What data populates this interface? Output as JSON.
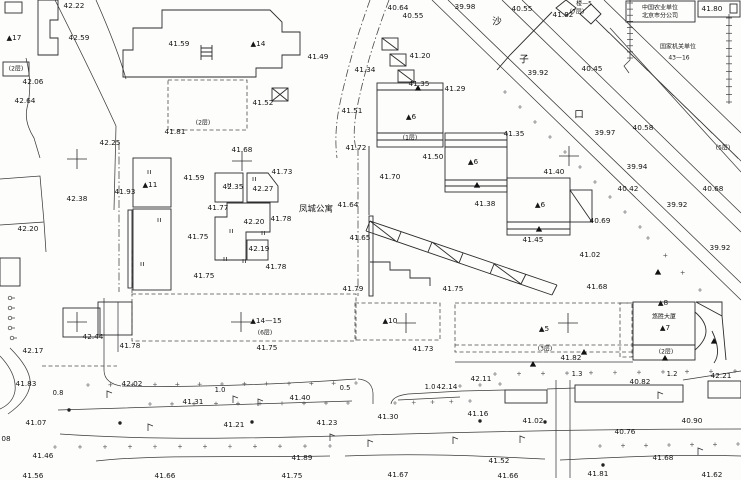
{
  "map": {
    "ink": "#161616",
    "line_color": "#3b3b3b",
    "background": "#fdfdfc",
    "labels": [
      {
        "t": "42.22",
        "x": 74,
        "y": 6
      },
      {
        "t": "40.64",
        "x": 398,
        "y": 8
      },
      {
        "t": "40.55",
        "x": 413,
        "y": 16
      },
      {
        "t": "39.98",
        "x": 465,
        "y": 7
      },
      {
        "t": "40.55",
        "x": 522,
        "y": 9
      },
      {
        "t": "41.82",
        "x": 563,
        "y": 15
      },
      {
        "t": "楼—5",
        "x": 584,
        "y": 4,
        "cls": "floors"
      },
      {
        "t": "(7层)",
        "x": 577,
        "y": 12,
        "cls": "floors"
      },
      {
        "t": "中国农业单位",
        "x": 660,
        "y": 8,
        "cls": "name-sm"
      },
      {
        "t": "北京市分公司",
        "x": 660,
        "y": 16,
        "cls": "name-sm"
      },
      {
        "t": "41.80",
        "x": 712,
        "y": 9
      },
      {
        "t": "▲17",
        "x": 14,
        "y": 38,
        "cls": "bldg"
      },
      {
        "t": "42.59",
        "x": 79,
        "y": 38
      },
      {
        "t": "41.59",
        "x": 179,
        "y": 44
      },
      {
        "t": "▲14",
        "x": 258,
        "y": 44,
        "cls": "bldg"
      },
      {
        "t": "沙",
        "x": 497,
        "y": 22,
        "cls": "street"
      },
      {
        "t": "子",
        "x": 524,
        "y": 60,
        "cls": "street"
      },
      {
        "t": "口",
        "x": 579,
        "y": 115,
        "cls": "street"
      },
      {
        "t": "国家机关单位",
        "x": 678,
        "y": 47,
        "cls": "name-sm"
      },
      {
        "t": "43—16",
        "x": 679,
        "y": 58,
        "cls": "name-sm"
      },
      {
        "t": "41.20",
        "x": 420,
        "y": 56
      },
      {
        "t": "41.34",
        "x": 365,
        "y": 70
      },
      {
        "t": "41.49",
        "x": 318,
        "y": 57
      },
      {
        "t": "42.06",
        "x": 33,
        "y": 82
      },
      {
        "t": "40.45",
        "x": 592,
        "y": 69
      },
      {
        "t": "39.92",
        "x": 538,
        "y": 73
      },
      {
        "t": "(2层)",
        "x": 16,
        "y": 69,
        "cls": "floors"
      },
      {
        "t": "42.64",
        "x": 25,
        "y": 101
      },
      {
        "t": "41.35",
        "x": 419,
        "y": 84
      },
      {
        "t": "41.29",
        "x": 455,
        "y": 89
      },
      {
        "t": "41.52",
        "x": 263,
        "y": 103
      },
      {
        "t": "41.51",
        "x": 352,
        "y": 111
      },
      {
        "t": "▲6",
        "x": 411,
        "y": 117,
        "cls": "bldg"
      },
      {
        "t": "(2层)",
        "x": 203,
        "y": 123,
        "cls": "floors"
      },
      {
        "t": "41.81",
        "x": 175,
        "y": 132
      },
      {
        "t": "40.58",
        "x": 643,
        "y": 128
      },
      {
        "t": "39.97",
        "x": 605,
        "y": 133
      },
      {
        "t": "41.35",
        "x": 514,
        "y": 134
      },
      {
        "t": "(5层)",
        "x": 723,
        "y": 148,
        "cls": "floors"
      },
      {
        "t": "42.25",
        "x": 110,
        "y": 143
      },
      {
        "t": "41.72",
        "x": 356,
        "y": 148
      },
      {
        "t": "41.68",
        "x": 242,
        "y": 150
      },
      {
        "t": "(1层)",
        "x": 410,
        "y": 138,
        "cls": "floors"
      },
      {
        "t": "41.50",
        "x": 433,
        "y": 157
      },
      {
        "t": "▲6",
        "x": 473,
        "y": 162,
        "cls": "bldg"
      },
      {
        "t": "41.40",
        "x": 554,
        "y": 172
      },
      {
        "t": "39.94",
        "x": 637,
        "y": 167
      },
      {
        "t": "41.73",
        "x": 282,
        "y": 172
      },
      {
        "t": "41.59",
        "x": 194,
        "y": 178
      },
      {
        "t": "41.70",
        "x": 390,
        "y": 177
      },
      {
        "t": "▲11",
        "x": 150,
        "y": 185,
        "cls": "bldg"
      },
      {
        "t": "41.93",
        "x": 125,
        "y": 192
      },
      {
        "t": "42.35",
        "x": 233,
        "y": 187
      },
      {
        "t": "42.27",
        "x": 263,
        "y": 189
      },
      {
        "t": "40.42",
        "x": 628,
        "y": 189
      },
      {
        "t": "40.68",
        "x": 713,
        "y": 189
      },
      {
        "t": "42.38",
        "x": 77,
        "y": 199
      },
      {
        "t": "41.77",
        "x": 218,
        "y": 208
      },
      {
        "t": "▲6",
        "x": 540,
        "y": 205,
        "cls": "bldg"
      },
      {
        "t": "41.38",
        "x": 485,
        "y": 204
      },
      {
        "t": "41.64",
        "x": 348,
        "y": 205
      },
      {
        "t": "凤城公寓",
        "x": 316,
        "y": 209,
        "cls": "name"
      },
      {
        "t": "39.92",
        "x": 677,
        "y": 205
      },
      {
        "t": "40.69",
        "x": 600,
        "y": 221
      },
      {
        "t": "42.20",
        "x": 254,
        "y": 222
      },
      {
        "t": "41.78",
        "x": 281,
        "y": 219
      },
      {
        "t": "42.20",
        "x": 28,
        "y": 229
      },
      {
        "t": "41.75",
        "x": 198,
        "y": 237
      },
      {
        "t": "41.65",
        "x": 360,
        "y": 238
      },
      {
        "t": "41.45",
        "x": 533,
        "y": 240
      },
      {
        "t": "39.92",
        "x": 720,
        "y": 248
      },
      {
        "t": "42.19",
        "x": 259,
        "y": 249
      },
      {
        "t": "41.02",
        "x": 590,
        "y": 255
      },
      {
        "t": "41.78",
        "x": 276,
        "y": 267
      },
      {
        "t": "41.75",
        "x": 204,
        "y": 276
      },
      {
        "t": "41.68",
        "x": 597,
        "y": 287
      },
      {
        "t": "41.79",
        "x": 353,
        "y": 289
      },
      {
        "t": "41.75",
        "x": 453,
        "y": 289
      },
      {
        "t": "▲8",
        "x": 663,
        "y": 303,
        "cls": "bldg"
      },
      {
        "t": "▲14—15",
        "x": 266,
        "y": 321,
        "cls": "bldg"
      },
      {
        "t": "▲10",
        "x": 390,
        "y": 321,
        "cls": "bldg"
      },
      {
        "t": "▲5",
        "x": 544,
        "y": 329,
        "cls": "bldg"
      },
      {
        "t": "悠胜大厦",
        "x": 664,
        "y": 317,
        "cls": "name-sm"
      },
      {
        "t": "▲7",
        "x": 665,
        "y": 328,
        "cls": "bldg"
      },
      {
        "t": "(6层)",
        "x": 265,
        "y": 333,
        "cls": "floors"
      },
      {
        "t": "42.44",
        "x": 93,
        "y": 337
      },
      {
        "t": "41.78",
        "x": 130,
        "y": 346
      },
      {
        "t": "41.75",
        "x": 267,
        "y": 348
      },
      {
        "t": "41.73",
        "x": 423,
        "y": 349
      },
      {
        "t": "(3层)",
        "x": 545,
        "y": 349,
        "cls": "floors"
      },
      {
        "t": "(2层)",
        "x": 666,
        "y": 352,
        "cls": "floors"
      },
      {
        "t": "42.17",
        "x": 33,
        "y": 351
      },
      {
        "t": "41.82",
        "x": 571,
        "y": 358
      },
      {
        "t": "41.83",
        "x": 26,
        "y": 384
      },
      {
        "t": "42.02",
        "x": 132,
        "y": 384
      },
      {
        "t": "0.8",
        "x": 58,
        "y": 393,
        "cls": "width"
      },
      {
        "t": "1.0",
        "x": 220,
        "y": 390,
        "cls": "width"
      },
      {
        "t": "41.31",
        "x": 193,
        "y": 402
      },
      {
        "t": "41.40",
        "x": 300,
        "y": 398
      },
      {
        "t": "0.5",
        "x": 345,
        "y": 388,
        "cls": "width"
      },
      {
        "t": "1.0",
        "x": 430,
        "y": 387,
        "cls": "width"
      },
      {
        "t": "42.14",
        "x": 447,
        "y": 387
      },
      {
        "t": "42.11",
        "x": 481,
        "y": 379
      },
      {
        "t": "1.3",
        "x": 577,
        "y": 374,
        "cls": "width"
      },
      {
        "t": "1.2",
        "x": 672,
        "y": 374,
        "cls": "width"
      },
      {
        "t": "42.21",
        "x": 721,
        "y": 376
      },
      {
        "t": "40.82",
        "x": 640,
        "y": 382
      },
      {
        "t": "41.07",
        "x": 36,
        "y": 423
      },
      {
        "t": "41.21",
        "x": 234,
        "y": 425
      },
      {
        "t": "41.23",
        "x": 327,
        "y": 423
      },
      {
        "t": "41.30",
        "x": 388,
        "y": 417
      },
      {
        "t": "41.16",
        "x": 478,
        "y": 414
      },
      {
        "t": "41.02",
        "x": 533,
        "y": 421
      },
      {
        "t": "40.90",
        "x": 692,
        "y": 421
      },
      {
        "t": "40.76",
        "x": 625,
        "y": 432
      },
      {
        "t": "08",
        "x": 6,
        "y": 439
      },
      {
        "t": "41.46",
        "x": 43,
        "y": 456
      },
      {
        "t": "41.89",
        "x": 302,
        "y": 458
      },
      {
        "t": "41.52",
        "x": 499,
        "y": 461
      },
      {
        "t": "41.68",
        "x": 663,
        "y": 458
      },
      {
        "t": "41.56",
        "x": 33,
        "y": 476
      },
      {
        "t": "41.66",
        "x": 165,
        "y": 476
      },
      {
        "t": "41.75",
        "x": 292,
        "y": 476
      },
      {
        "t": "41.67",
        "x": 398,
        "y": 475
      },
      {
        "t": "41.66",
        "x": 508,
        "y": 476
      },
      {
        "t": "41.81",
        "x": 598,
        "y": 474
      },
      {
        "t": "41.62",
        "x": 712,
        "y": 475
      }
    ],
    "crosses": [
      [
        77,
        159
      ],
      [
        242,
        161
      ],
      [
        569,
        156
      ],
      [
        77,
        322
      ],
      [
        241,
        322
      ],
      [
        406,
        323
      ],
      [
        568,
        323
      ]
    ],
    "triangles": [
      [
        418,
        88
      ],
      [
        477,
        185
      ],
      [
        539,
        229
      ],
      [
        584,
        352
      ],
      [
        533,
        364
      ],
      [
        665,
        358
      ],
      [
        714,
        341
      ],
      [
        658,
        272
      ]
    ],
    "door_ticks": [
      [
        228,
        183
      ],
      [
        253,
        177
      ],
      [
        230,
        229
      ],
      [
        224,
        257
      ],
      [
        243,
        259
      ],
      [
        262,
        231
      ],
      [
        148,
        170
      ],
      [
        158,
        218
      ],
      [
        141,
        262
      ]
    ],
    "lamps": [
      [
        107,
        398
      ],
      [
        233,
        403
      ],
      [
        330,
        441
      ],
      [
        368,
        447
      ],
      [
        658,
        399
      ],
      [
        148,
        431
      ],
      [
        520,
        443
      ],
      [
        698,
        455
      ],
      [
        258,
        406
      ],
      [
        453,
        444
      ]
    ],
    "poles": [
      [
        69,
        410
      ],
      [
        252,
        422
      ],
      [
        480,
        421
      ],
      [
        545,
        422
      ],
      [
        603,
        465
      ],
      [
        120,
        423
      ]
    ],
    "fence_posts": [
      [
        10,
        298
      ],
      [
        10,
        308
      ],
      [
        10,
        318
      ],
      [
        10,
        328
      ],
      [
        12,
        338
      ]
    ],
    "dot_rows": [
      [
        88,
        385,
        356,
        383,
        13
      ],
      [
        150,
        404,
        348,
        403,
        10
      ],
      [
        460,
        386,
        500,
        384,
        3
      ],
      [
        495,
        374,
        735,
        371,
        11
      ],
      [
        55,
        447,
        330,
        446,
        12
      ],
      [
        600,
        446,
        738,
        444,
        7
      ],
      [
        505,
        92,
        640,
        227,
        10
      ],
      [
        648,
        238,
        700,
        290,
        4
      ],
      [
        395,
        403,
        470,
        401,
        5
      ]
    ],
    "tick_bands": [
      {
        "x0": 596,
        "y0": 20,
        "x1": 738,
        "y1": 158,
        "tx": 13,
        "ty": 13,
        "n": 12
      },
      {
        "x0": 627,
        "y0": 3,
        "x1": 627,
        "y1": 58,
        "tx": 6,
        "ty": 0,
        "n": 10
      },
      {
        "x0": 726,
        "y0": 18,
        "x1": 726,
        "y1": 102,
        "tx": 6,
        "ty": 0,
        "n": 12
      }
    ]
  }
}
